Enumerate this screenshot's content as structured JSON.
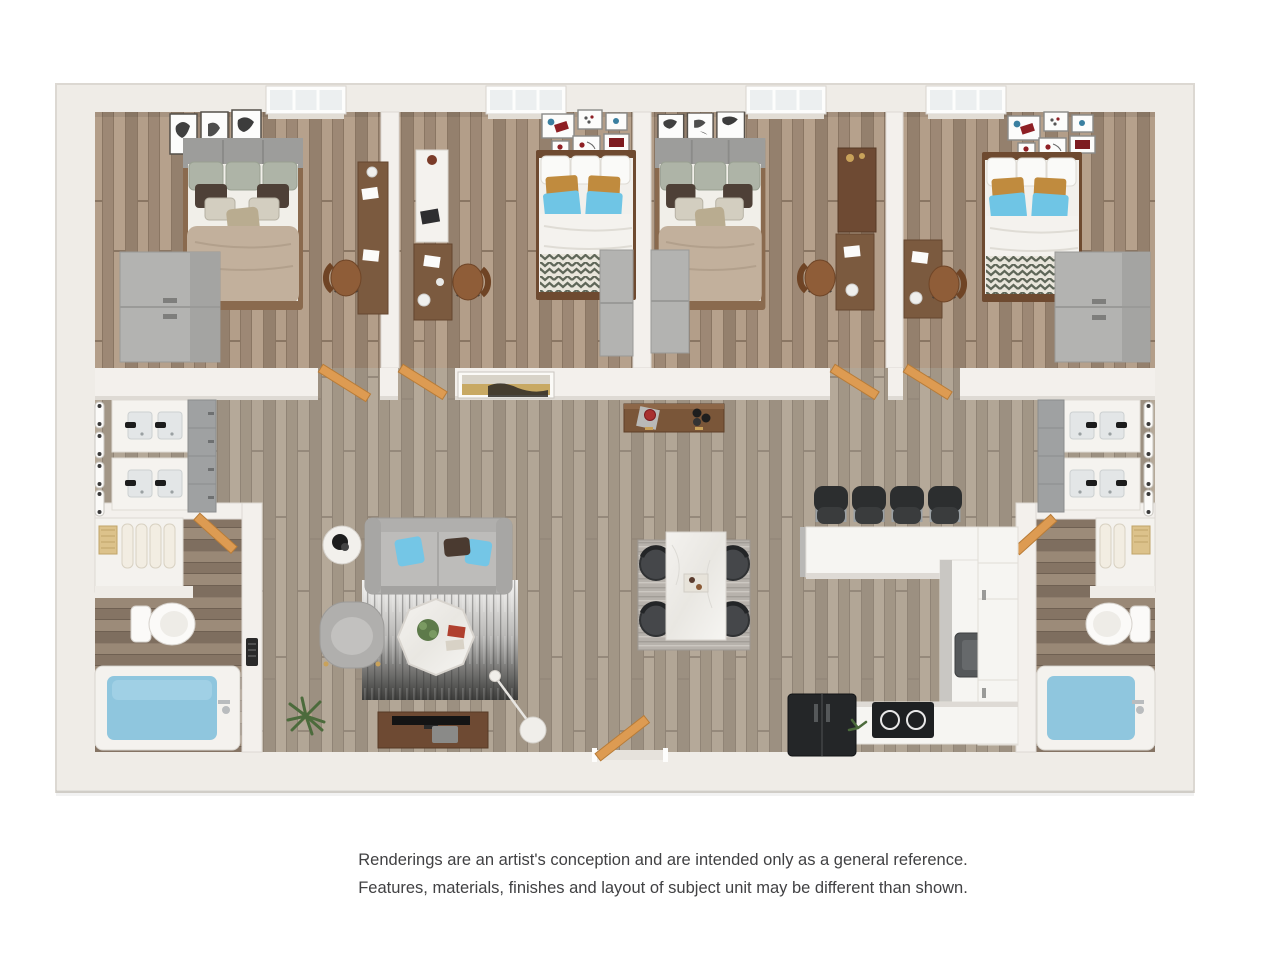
{
  "disclaimer": {
    "line1": "Renderings are an artist's conception and are intended only as a general reference.",
    "line2": "Features, materials, finishes and layout of subject unit may be different than shown.",
    "text_color": "#414143"
  },
  "floorplan": {
    "type": "3d-rendered-floor-plan-top-view",
    "rooms": [
      {
        "name": "bedroom-1",
        "furniture": [
          "bed",
          "dresser",
          "desk",
          "task-chair",
          "window",
          "wall-art-3-frames",
          "door"
        ]
      },
      {
        "name": "bedroom-2",
        "furniture": [
          "bed",
          "wardrobe",
          "dresser",
          "desk",
          "task-chair",
          "window",
          "wall-art-gallery",
          "door"
        ]
      },
      {
        "name": "bedroom-3",
        "furniture": [
          "bed",
          "wardrobe",
          "dresser",
          "desk",
          "task-chair",
          "window",
          "wall-art-3-frames",
          "door"
        ]
      },
      {
        "name": "bedroom-4",
        "furniture": [
          "bed",
          "dresser",
          "desk",
          "task-chair",
          "window",
          "wall-art-gallery",
          "door"
        ]
      },
      {
        "name": "bathroom-left",
        "furniture": [
          "double-vanity-1",
          "double-vanity-2",
          "cabinet-tower",
          "towel-shelf",
          "toilet",
          "bathtub",
          "door",
          "wall-vent"
        ]
      },
      {
        "name": "bathroom-right",
        "furniture": [
          "double-vanity-1",
          "double-vanity-2",
          "cabinet-tower",
          "towel-shelf",
          "toilet",
          "bathtub",
          "door"
        ]
      },
      {
        "name": "living-room",
        "furniture": [
          "sofa",
          "armchair",
          "side-table",
          "coffee-table",
          "area-rug",
          "tv-stand",
          "tv",
          "arc-floor-lamp",
          "plant"
        ]
      },
      {
        "name": "dining-area",
        "furniture": [
          "dining-table",
          "dining-rug",
          "dining-chair-x4"
        ]
      },
      {
        "name": "kitchen",
        "furniture": [
          "breakfast-bar",
          "bar-stool-x4",
          "sink",
          "cooktop",
          "refrigerator",
          "pantry-cabinets",
          "base-counter"
        ]
      },
      {
        "name": "hallway",
        "furniture": [
          "console-table",
          "wall-art-landscape",
          "entry-door"
        ]
      }
    ],
    "counts": {
      "bedrooms": 4,
      "bathrooms": 2,
      "bar_stools": 4,
      "dining_chairs": 4,
      "bathtubs": 2,
      "toilets": 2,
      "windows": 4
    }
  },
  "colors": {
    "background": "#ffffff",
    "wall": "#f2efea",
    "wall_shade": "#dcd8d2",
    "floor_main": "#aca091",
    "floor_bedroom": "#a8937f",
    "floor_bath": "#8f7e6e",
    "door_orange": "#dd9b52",
    "pillow_blue": "#6fc5e5",
    "pillow_gold": "#c08b3e",
    "duvet_tan": "#c2b09c",
    "headboard_gray": "#9d9d9b",
    "chevron_olive": "#5f6759",
    "sofa_gray": "#b5b4b2",
    "rug_dark": "#3c3c3a",
    "wood_furniture": "#7b5a3f",
    "dresser_gray": "#b2b2b0",
    "counter_white": "#f7f6f3",
    "appliance_black": "#242628",
    "tub_water": "#8fc6de",
    "towel_beige": "#e8dfcf"
  }
}
